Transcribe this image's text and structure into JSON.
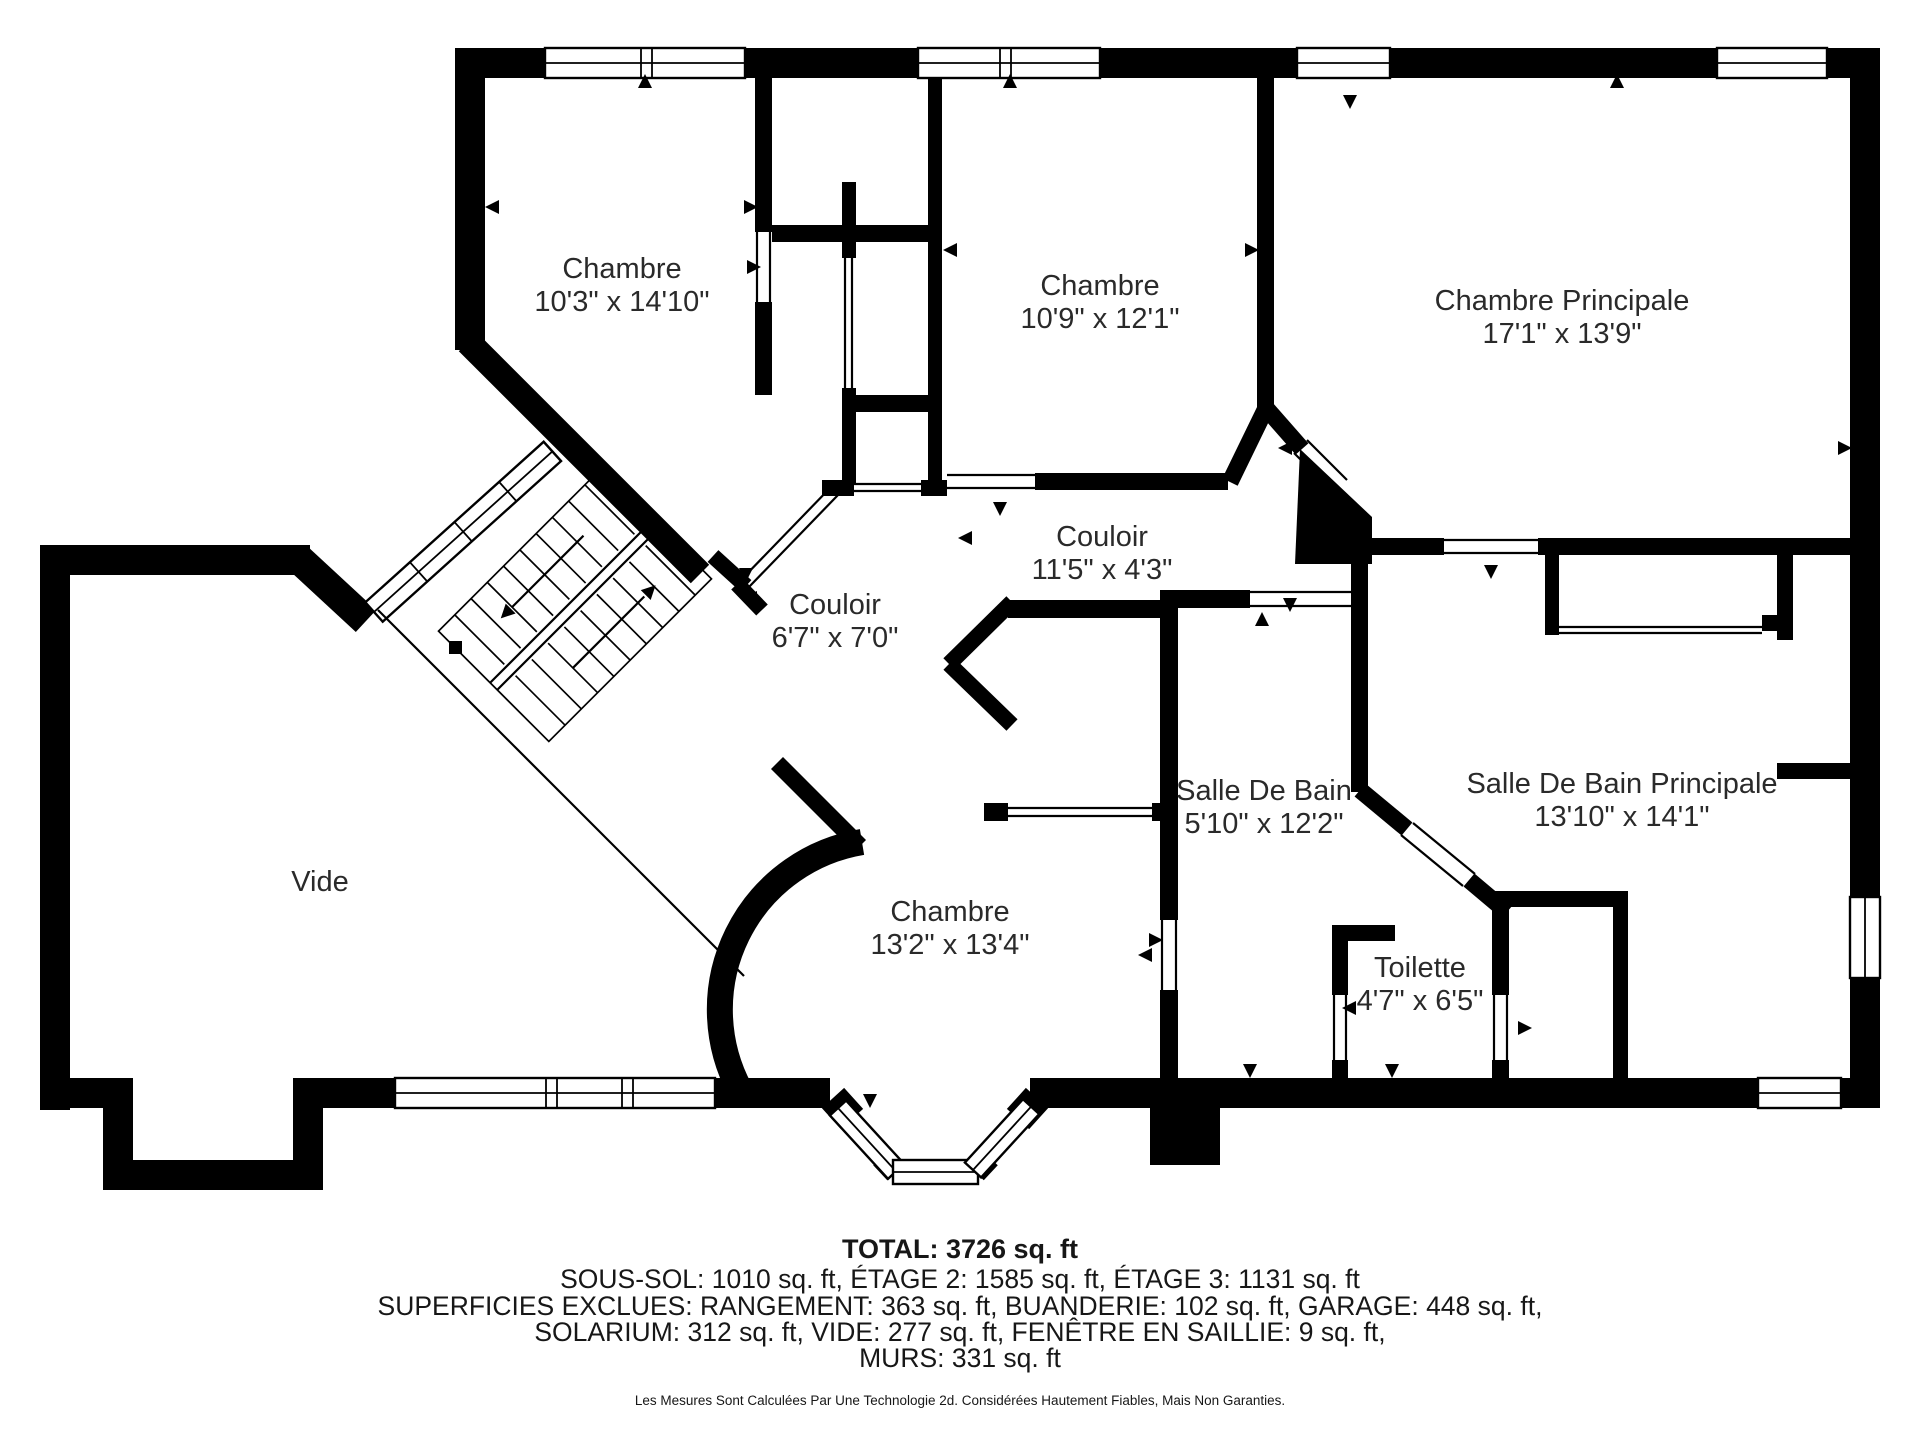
{
  "colors": {
    "wall": "#000000",
    "background": "#ffffff",
    "text": "#2a2a2a"
  },
  "rooms": [
    {
      "id": "chambre-1",
      "name": "Chambre",
      "dims": "10'3\" x 14'10\""
    },
    {
      "id": "chambre-2",
      "name": "Chambre",
      "dims": "10'9\" x 12'1\""
    },
    {
      "id": "chambre-principale",
      "name": "Chambre Principale",
      "dims": "17'1\" x 13'9\""
    },
    {
      "id": "couloir-1",
      "name": "Couloir",
      "dims": "11'5\" x 4'3\""
    },
    {
      "id": "couloir-2",
      "name": "Couloir",
      "dims": "6'7\" x 7'0\""
    },
    {
      "id": "salle-de-bain",
      "name": "Salle De Bain",
      "dims": "5'10\" x 12'2\""
    },
    {
      "id": "salle-de-bain-principale",
      "name": "Salle De Bain Principale",
      "dims": "13'10\" x 14'1\""
    },
    {
      "id": "toilette",
      "name": "Toilette",
      "dims": "4'7\" x 6'5\""
    },
    {
      "id": "chambre-3",
      "name": "Chambre",
      "dims": "13'2\" x 13'4\""
    },
    {
      "id": "vide",
      "name": "Vide",
      "dims": ""
    }
  ],
  "summary": {
    "total": "TOTAL: 3726 sq. ft",
    "line2": "SOUS-SOL: 1010 sq. ft, ÉTAGE 2: 1585 sq. ft, ÉTAGE 3: 1131 sq. ft",
    "line3": "SUPERFICIES EXCLUES: RANGEMENT: 363 sq. ft, BUANDERIE: 102 sq. ft, GARAGE: 448 sq. ft,",
    "line4": "SOLARIUM: 312 sq. ft, VIDE: 277 sq. ft, FENÊTRE EN SAILLIE: 9 sq. ft,",
    "line5": "MURS: 331 sq. ft"
  },
  "disclaimer": "Les Mesures Sont Calculées Par Une Technologie 2d. Considérées Hautement Fiables, Mais Non Garanties."
}
